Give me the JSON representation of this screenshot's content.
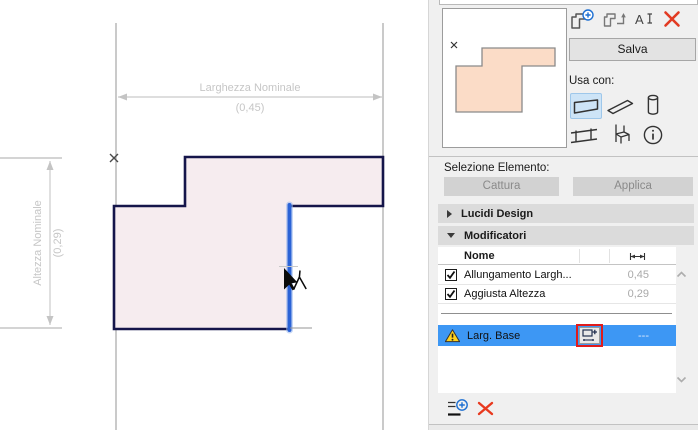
{
  "colors": {
    "selection_blue": "#3d97f4",
    "accent_blue": "#1d6fd2",
    "highlighted_edge_blue": "#2b63d6",
    "delete_red": "#e23b23",
    "warning_yellow": "#ffd21c",
    "canvas_shape_fill": "#f6ecef",
    "canvas_shape_stroke": "#15154a",
    "preview_shape_fill": "#fbdcc7"
  },
  "canvas": {
    "width_dim": {
      "label": "Larghezza Nominale",
      "value": "(0,45)"
    },
    "height_dim": {
      "label": "Altezza Nominale",
      "value": "(0,29)"
    }
  },
  "panel": {
    "toolbar_icons": [
      "new-profile",
      "capture-profile",
      "rename",
      "delete"
    ],
    "save_button": "Salva",
    "use_with_label": "Usa con:",
    "use_with_icons": [
      "wall",
      "beam",
      "column",
      "railing",
      "object",
      "info"
    ],
    "selection": {
      "label": "Selezione Elemento:",
      "capture": "Cattura",
      "apply": "Applica"
    },
    "sections": {
      "design_layers": "Lucidi Design",
      "modifiers": "Modificatori"
    },
    "modifiers_table": {
      "name_header": "Nome",
      "value_header_icon": "dimension-arrows",
      "rows": [
        {
          "name": "Allungamento Largh...",
          "value": "0,45",
          "checked": true
        },
        {
          "name": "Aggiusta Altezza",
          "value": "0,29",
          "checked": true
        }
      ],
      "selected_row": {
        "name": "Larg. Base",
        "value": "---",
        "warning": true
      }
    }
  }
}
